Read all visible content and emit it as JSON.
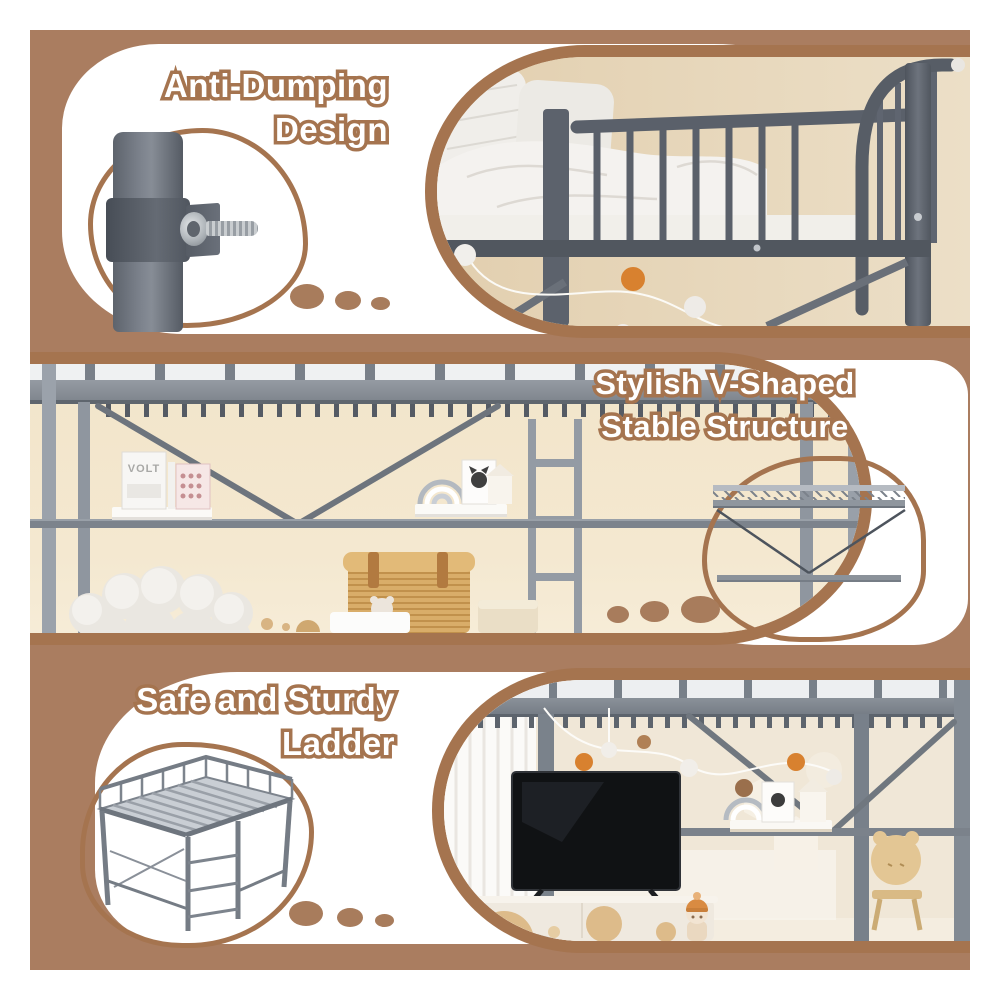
{
  "colors": {
    "panel_brown": "#aa7d60",
    "outline_brown": "#a5744f",
    "dot_brown": "#a87c5c",
    "text_fill": "#ffffff"
  },
  "features": [
    {
      "id": "anti-dumping-design",
      "title_line1": "Anti-Dumping",
      "title_line2": "Design",
      "illustration": "pole-clamp-closeup",
      "photo": "loft-bed-top-bedding-photo",
      "dot_count": 3
    },
    {
      "id": "v-shaped-structure",
      "title_line1": "Stylish V-Shaped",
      "title_line2": "Stable Structure",
      "illustration": "v-brace-diagram",
      "photo": "loft-bed-under-shelf-photo",
      "dot_count": 3,
      "photo_poster_label": "VOLT"
    },
    {
      "id": "safe-sturdy-ladder",
      "title_line1": "Safe and Sturdy",
      "title_line2": "Ladder",
      "illustration": "ladder-frame-render",
      "photo": "loft-bed-tv-room-photo",
      "dot_count": 3
    }
  ]
}
